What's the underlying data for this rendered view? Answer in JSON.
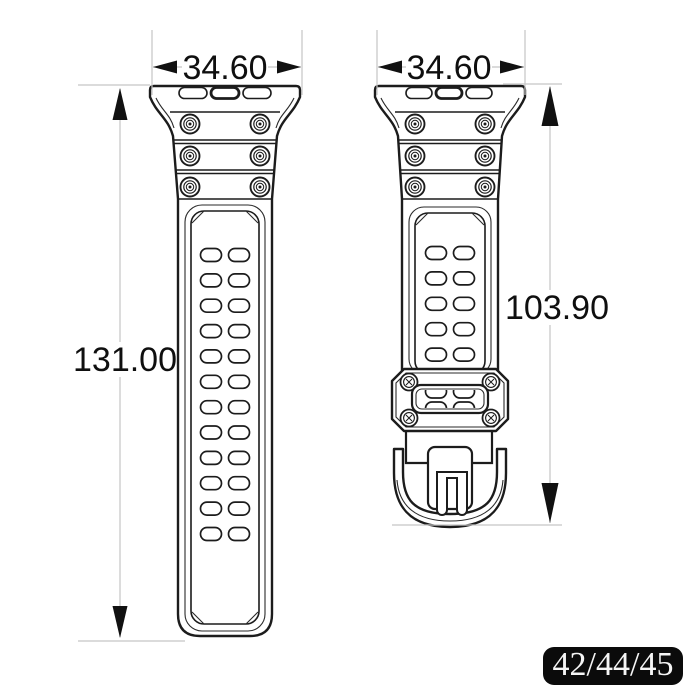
{
  "dimensions": {
    "left_width": "34.60",
    "right_width": "34.60",
    "left_length": "131.00",
    "right_length": "103.90"
  },
  "left_strap": {
    "hole_rows": 12,
    "hole_columns": 2,
    "screw_count": 6,
    "adapter_slots": 3
  },
  "right_strap": {
    "hole_rows": 5,
    "hole_columns": 2,
    "screw_count": 6,
    "adapter_slots": 3,
    "keeper_window_hole_rows": 2,
    "keeper_window_hole_columns": 2
  },
  "size_badge": {
    "label": "42/44/45"
  },
  "colors": {
    "outline": "#1c1c1c",
    "dimension_line": "#c5c5c5",
    "dimension_text": "#0f0f0f",
    "badge_background": "#0b0b0b",
    "badge_text": "#f5f5f5",
    "background": "#ffffff"
  }
}
